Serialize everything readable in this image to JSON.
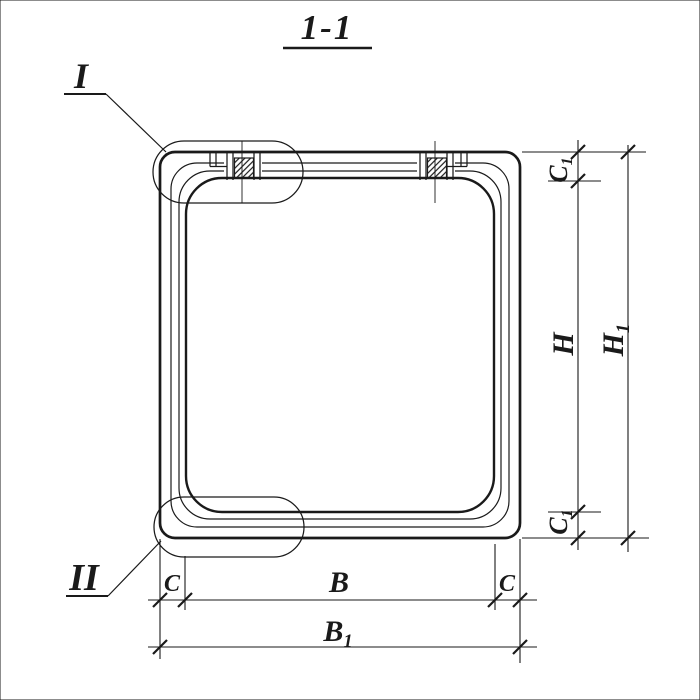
{
  "title": "1-1",
  "colors": {
    "ink": "#1a1a1a",
    "paper": "#ffffff"
  },
  "details": {
    "callout_top": "I",
    "callout_bottom": "II"
  },
  "dimensions": {
    "c_left": "C",
    "b": "B",
    "c_right": "C",
    "b1": {
      "main": "B",
      "sub": "1"
    },
    "c1_top": {
      "main": "C",
      "sub": "1"
    },
    "h": "H",
    "c1_bottom": {
      "main": "C",
      "sub": "1"
    },
    "h1": {
      "main": "H",
      "sub": "1"
    }
  }
}
